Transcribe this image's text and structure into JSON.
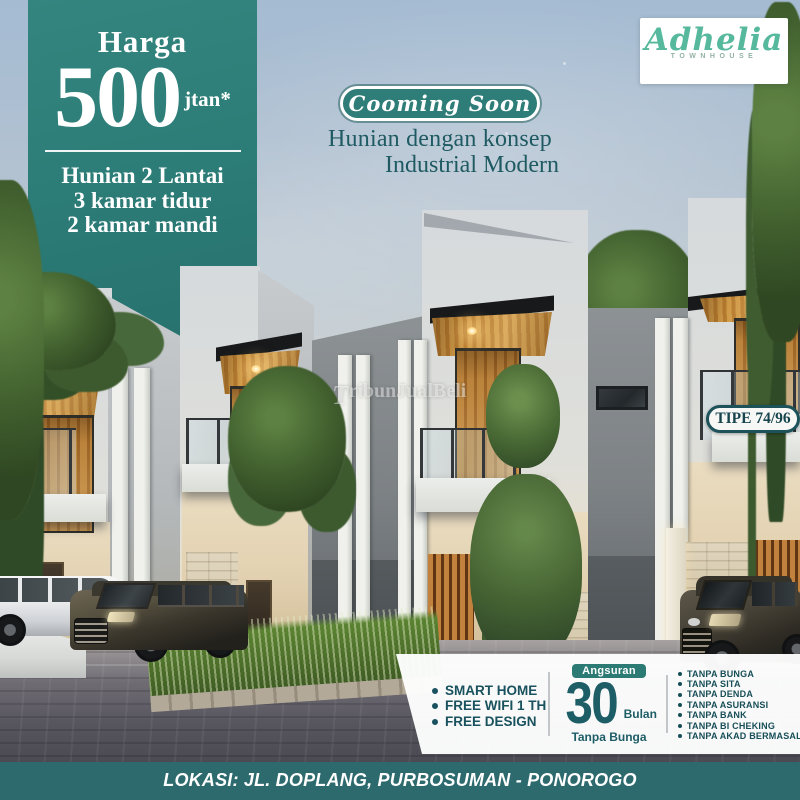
{
  "poster": {
    "price_banner": {
      "label": "Harga",
      "price": "500",
      "price_suffix": "jtan*",
      "specs": [
        "Hunian 2 Lantai",
        "3 kamar tidur",
        "2 kamar mandi"
      ]
    },
    "logo": {
      "brand": "Adhelia",
      "subtitle": "TOWNHOUSE"
    },
    "announcement": {
      "badge": "Cooming Soon",
      "line1": "Hunian dengan konsep",
      "line2": "Industrial Modern"
    },
    "type_badge": {
      "label": "TIPE 74/96"
    },
    "watermark": {
      "initial": "T",
      "rest": "ribunJualBeli"
    },
    "features_band": {
      "perks": [
        "SMART HOME",
        "FREE WIFI 1 TH",
        "FREE DESIGN"
      ],
      "installment": {
        "badge": "Angsuran",
        "number": "30",
        "unit": "Bulan",
        "note": "Tanpa Bunga"
      },
      "guarantees": [
        "TANPA BUNGA",
        "TANPA SITA",
        "TANPA DENDA",
        "TANPA ASURANSI",
        "TANPA BANK",
        "TANPA BI CHEKING",
        "TANPA AKAD BERMASALAH"
      ]
    },
    "location_bar": {
      "text": "LOKASI: JL. DOPLANG, PURBOSUMAN - PONOROGO"
    },
    "colors": {
      "banner_teal": "#2c7e79",
      "bar_teal": "#2d6a6e",
      "accent_dark_teal": "#1d5c63",
      "logo_mint": "#56b89c",
      "badge_teal": "#2b7a73"
    }
  }
}
